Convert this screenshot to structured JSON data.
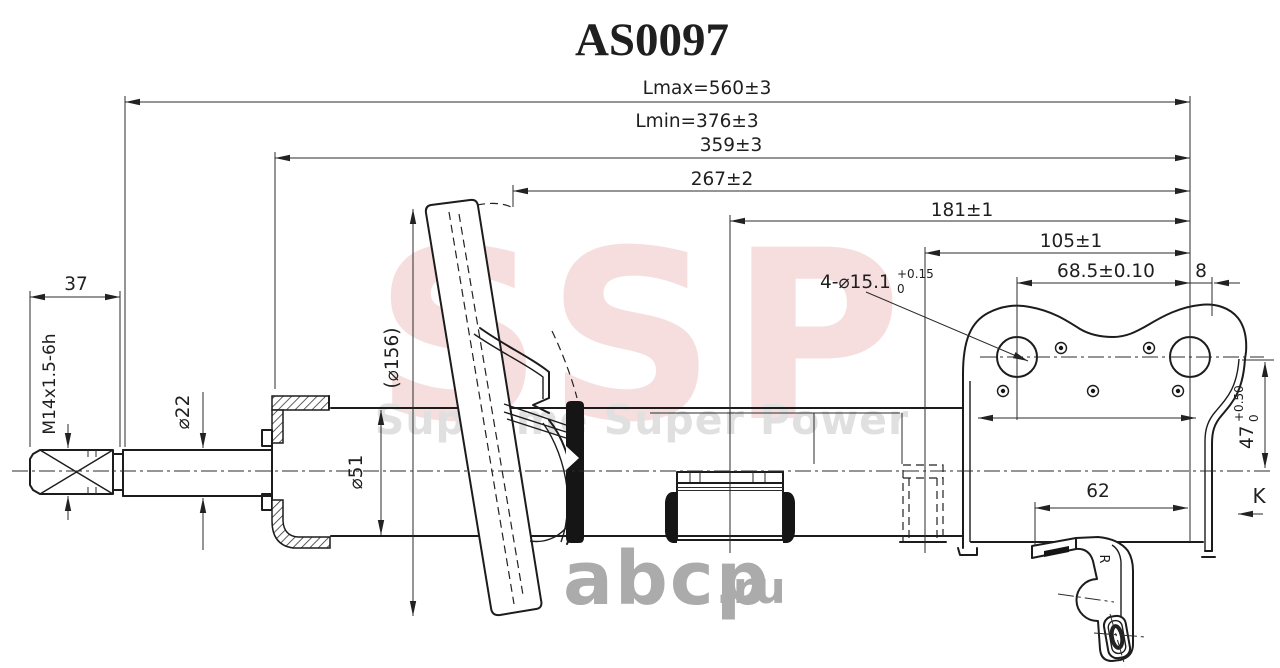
{
  "title": "AS0097",
  "watermarks": {
    "brand": "SSP",
    "slogan": "Supreme Super Power",
    "site": "abcp",
    "site_tld": ".ru"
  },
  "dims": {
    "lmax": "Lmax=560±3",
    "lmin": "Lmin=376±3",
    "len359": "359±3",
    "len267": "267±2",
    "len181": "181±1",
    "len105": "105±1",
    "len68": "68.5±0.10",
    "len8": "8",
    "len37": "37",
    "len62": "62",
    "thread": "M14x1.5-6h",
    "rod_dia": "⌀22",
    "body_dia": "⌀51",
    "seat_dia": "(⌀156)",
    "holes": "4-⌀15.1",
    "holes_tol_plus": "+0.15",
    "holes_tol_minus": "0",
    "height47": "47",
    "h47_tol_plus": "+0.50",
    "h47_tol_minus": "0",
    "view_k": "K",
    "mark_r": "R"
  }
}
